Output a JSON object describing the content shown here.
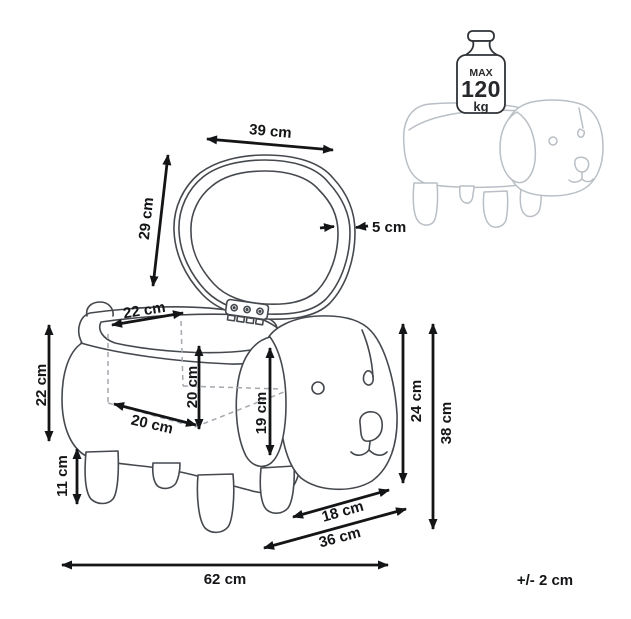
{
  "product_diagram": {
    "lid": {
      "width": "39 cm",
      "height": "29 cm",
      "thickness": "5 cm"
    },
    "opening": {
      "width": "22 cm",
      "inner_height": "20 cm",
      "inner_depth": "20 cm"
    },
    "body": {
      "height": "22 cm",
      "leg_height": "11 cm",
      "ear_height": "19 cm"
    },
    "overall": {
      "seat_height": "24 cm",
      "total_height": "38 cm",
      "head_depth": "18 cm",
      "total_depth": "36 cm",
      "total_width": "62 cm"
    },
    "weight_limit": {
      "prefix": "MAX",
      "value": "120",
      "unit": "kg"
    },
    "tolerance": "+/- 2 cm",
    "colors": {
      "line_dark": "#45494e",
      "line_dimension": "#141517",
      "line_light": "#b9bfc5",
      "background": "#ffffff"
    }
  }
}
